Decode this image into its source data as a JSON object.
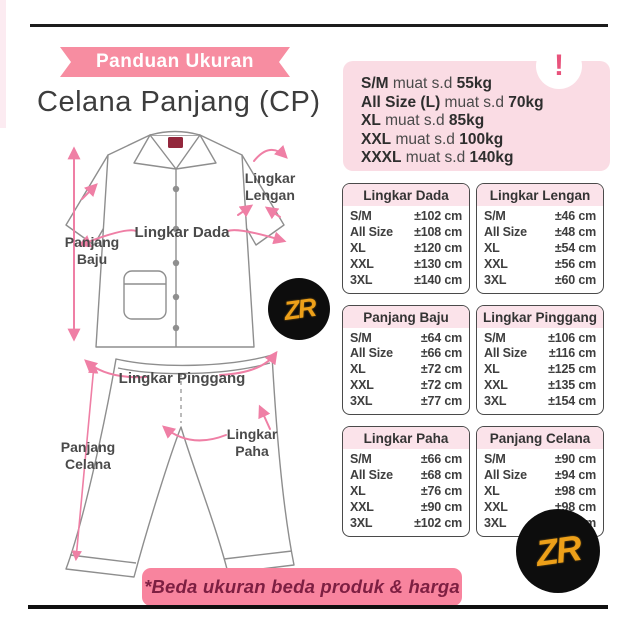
{
  "page": {
    "ribbon": "Panduan Ukuran",
    "title": "Celana Panjang (CP)",
    "footer_note": "*Beda ukuran beda produk & harga",
    "logo_text": "ZR",
    "alert_glyph": "!"
  },
  "capacity": {
    "rows": [
      {
        "size": "S/M",
        "mid": "muat s.d",
        "weight": "55kg"
      },
      {
        "size": "All Size (L)",
        "mid": "muat s.d",
        "weight": "70kg"
      },
      {
        "size": "XL",
        "mid": "muat s.d",
        "weight": "85kg"
      },
      {
        "size": "XXL",
        "mid": "muat s.d",
        "weight": "100kg"
      },
      {
        "size": "XXXL",
        "mid": "muat s.d",
        "weight": "140kg"
      }
    ]
  },
  "size_tables": [
    {
      "title": "Lingkar Dada",
      "rows": [
        [
          "S/M",
          "±102 cm"
        ],
        [
          "All Size",
          "±108 cm"
        ],
        [
          "XL",
          "±120 cm"
        ],
        [
          "XXL",
          "±130 cm"
        ],
        [
          "3XL",
          "±140 cm"
        ]
      ]
    },
    {
      "title": "Lingkar Lengan",
      "rows": [
        [
          "S/M",
          "±46 cm"
        ],
        [
          "All Size",
          "±48 cm"
        ],
        [
          "XL",
          "±54 cm"
        ],
        [
          "XXL",
          "±56 cm"
        ],
        [
          "3XL",
          "±60 cm"
        ]
      ]
    },
    {
      "title": "Panjang Baju",
      "rows": [
        [
          "S/M",
          "±64 cm"
        ],
        [
          "All Size",
          "±66 cm"
        ],
        [
          "XL",
          "±72 cm"
        ],
        [
          "XXL",
          "±72 cm"
        ],
        [
          "3XL",
          "±77 cm"
        ]
      ]
    },
    {
      "title": "Lingkar Pinggang",
      "rows": [
        [
          "S/M",
          "±106 cm"
        ],
        [
          "All Size",
          "±116 cm"
        ],
        [
          "XL",
          "±125 cm"
        ],
        [
          "XXL",
          "±135 cm"
        ],
        [
          "3XL",
          "±154 cm"
        ]
      ]
    },
    {
      "title": "Lingkar Paha",
      "rows": [
        [
          "S/M",
          "±66 cm"
        ],
        [
          "All Size",
          "±68 cm"
        ],
        [
          "XL",
          "±76 cm"
        ],
        [
          "XXL",
          "±90 cm"
        ],
        [
          "3XL",
          "±102 cm"
        ]
      ]
    },
    {
      "title": "Panjang Celana",
      "rows": [
        [
          "S/M",
          "±90 cm"
        ],
        [
          "All Size",
          "±94 cm"
        ],
        [
          "XL",
          "±98 cm"
        ],
        [
          "XXL",
          "±98 cm"
        ],
        [
          "3XL",
          "±102 cm"
        ]
      ]
    }
  ],
  "diagram": {
    "labels": {
      "panjang_baju": [
        "Panjang",
        "Baju"
      ],
      "lingkar_dada": "Lingkar Dada",
      "lingkar_lengan": [
        "Lingkar",
        "Lengan"
      ],
      "lingkar_pinggang": "Lingkar Pinggang",
      "panjang_celana": [
        "Panjang",
        "Celana"
      ],
      "lingkar_paha": [
        "Lingkar",
        "Paha"
      ]
    }
  },
  "colors": {
    "ribbon_pink": "#f78da1",
    "banner_pink": "#f8849e",
    "panel_bg": "#fadce4",
    "table_header_bg": "#fbe3ea",
    "accent_pink": "#e8537c",
    "arrow_pink": "#ef7fa5",
    "maroon_text": "#7d1f42",
    "logo_gold": "#eda019",
    "outline_gray": "#8e8e8e",
    "ink": "#3a3a3a"
  }
}
